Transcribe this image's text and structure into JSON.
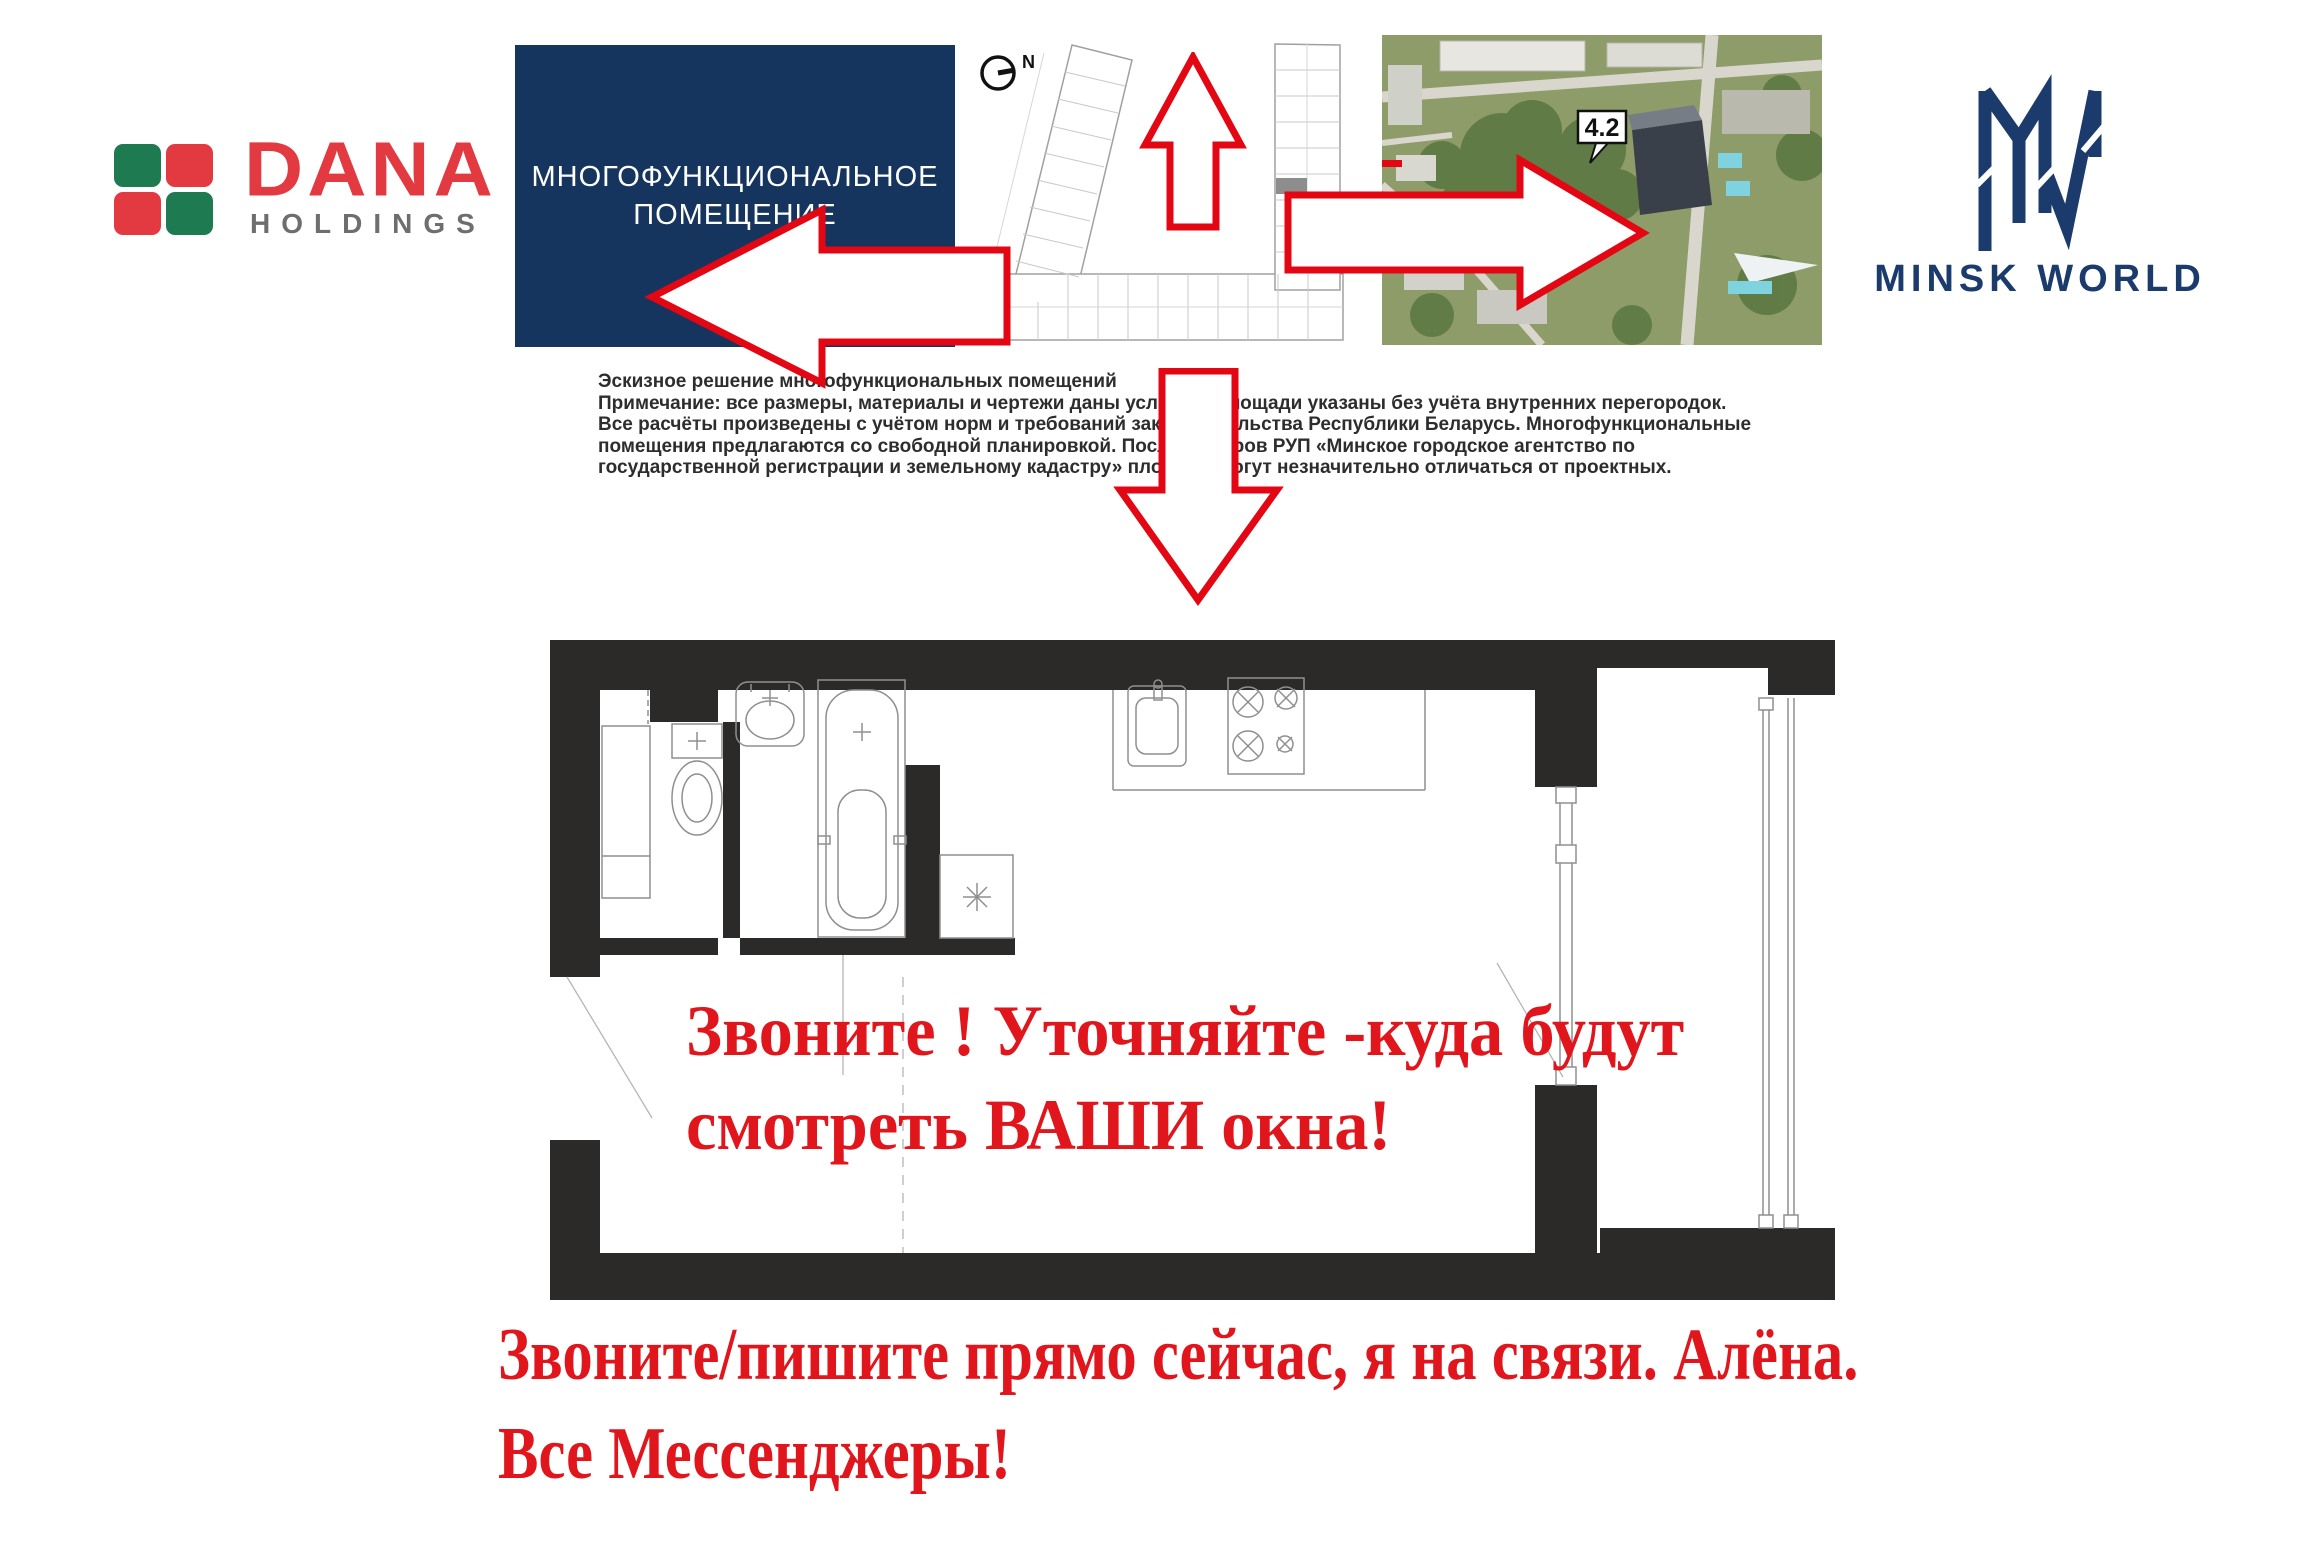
{
  "header": {
    "dana": {
      "word": "DANA",
      "sub": "HOLDINGS"
    },
    "title_box": {
      "line1": "МНОГОФУНКЦИОНАЛЬНОЕ",
      "line2": "ПОМЕЩЕНИЕ"
    },
    "site_plan": {
      "north": "N"
    },
    "aerial": {
      "badge": "4.2"
    },
    "minsk_world": {
      "brand": "MINSK WORLD"
    }
  },
  "disclaimer": {
    "lines": [
      "Эскизное решение многофункциональных помещений",
      "Примечание: все размеры, материалы и чертежи даны условно. Площади указаны без учёта внутренних перегородок.",
      "Все расчёты произведены с учётом норм и требований законодательства Республики Беларусь. Многофункциональные",
      "помещения предлагаются со свободной планировкой. После обмеров РУП «Минское городское агентство по",
      "государственной регистрации и земельному кадастру» площади могут незначительно отличаться от проектных."
    ]
  },
  "plan_overlay": {
    "line1": "Звоните ! Уточняйте -куда будут",
    "line2": "смотреть ВАШИ окна!"
  },
  "footer": {
    "line1": "Звоните/пишите прямо сейчас, я на связи. Алёна.",
    "line2": "Все Мессенджеры!"
  },
  "colors": {
    "arrow_red": "#e30613",
    "text_red": "#e0161c",
    "navy_box": "#16355e",
    "brand_navy": "#1c3b6d",
    "dana_red": "#e23a40",
    "dana_green": "#1e7a50",
    "dana_gray": "#6d6e71",
    "wall_black": "#2b2a29"
  }
}
